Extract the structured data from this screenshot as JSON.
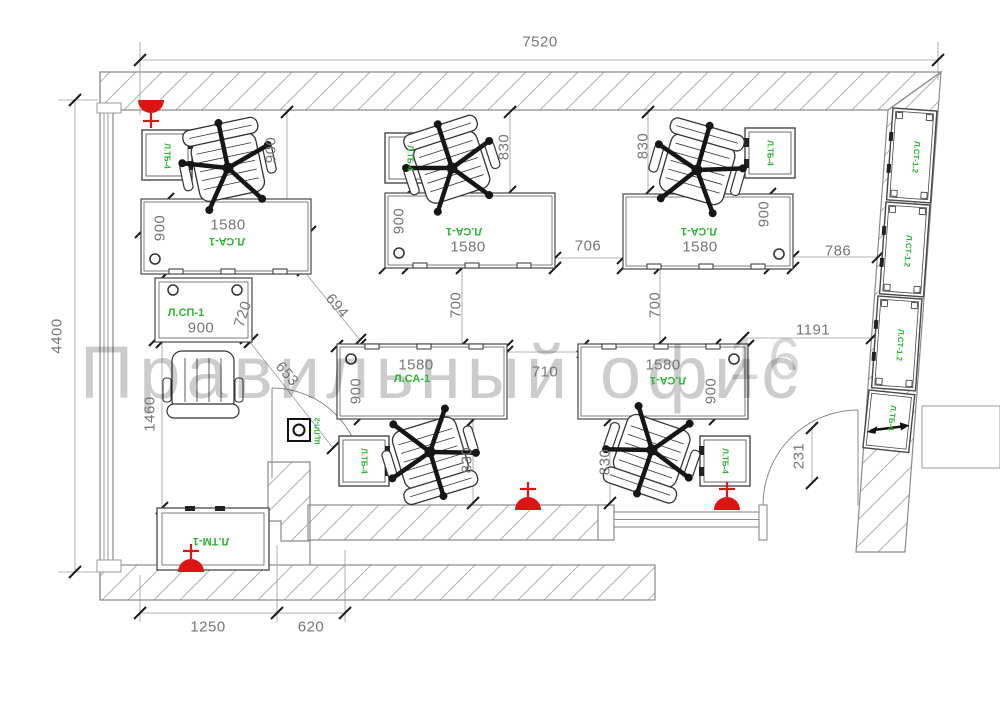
{
  "watermark": {
    "text": "Правильный офис",
    "area_number": "16"
  },
  "colors": {
    "label_green": "#2eb335",
    "light_red": "#dd1414",
    "line_gray": "#555555",
    "dim_gray": "#767676",
    "hatch_gray": "#b0b0b0",
    "watermark_gray": "rgba(0,0,0,0.20)"
  },
  "furniture_labels": {
    "workstation_desk": "Л.СА-1",
    "meeting_table": "Л.СП-1",
    "bedside_cabinet": "Л.ТБ-4",
    "tall_cabinet": "Л.СТ-1.2",
    "low_cabinet": "Л.ТМ-1",
    "electric_panel": "Щ.ПЛ-2"
  },
  "dims": {
    "overall_width": "7520",
    "overall_depth": "4400",
    "bottom_left_1": "1250",
    "bottom_left_2": "620",
    "desk_depth": "900",
    "desk_width": "1580",
    "gap_830": "830",
    "gap_700": "700",
    "gap_706": "706",
    "gap_710": "710",
    "gap_786": "786",
    "gap_1191": "1191",
    "sp_width": "900",
    "sp_depth": "720",
    "diag_694": "694",
    "diag_653": "653",
    "left_1460": "1460",
    "door_231": "231"
  }
}
